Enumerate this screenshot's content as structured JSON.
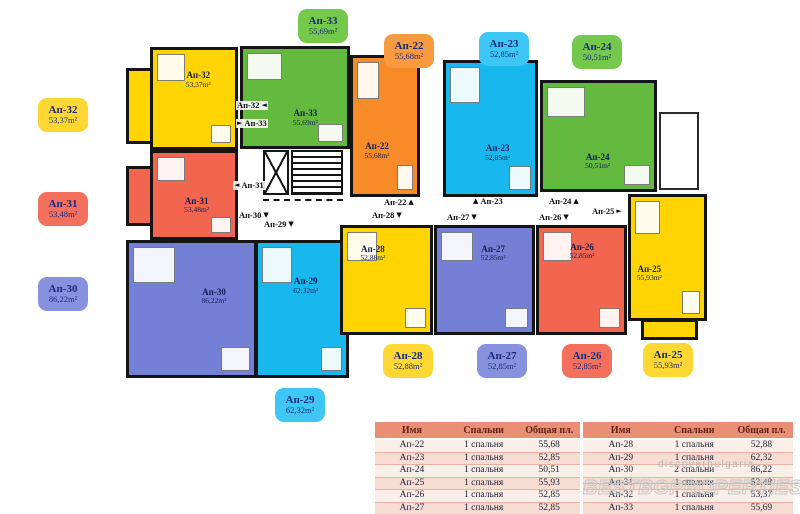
{
  "colors": {
    "yellow_unit": "#FFD400",
    "yellow_bubble": "#FFD732",
    "orange_unit": "#F68B28",
    "orange_bubble": "#F89A40",
    "red_unit": "#F26650",
    "red_bubble": "#F4705C",
    "green_unit": "#63BA3E",
    "green_bubble": "#74C94C",
    "cyan_unit": "#18B8EF",
    "cyan_bubble": "#3EC6F4",
    "blue_unit": "#7480D6",
    "blue_bubble": "#8792DF",
    "wall": "#141414",
    "table_header_bg": "#EA8F76"
  },
  "units": {
    "ap22": {
      "name": "Ап-22",
      "area": "55,68m²"
    },
    "ap23": {
      "name": "Ап-23",
      "area": "52,85m²"
    },
    "ap24": {
      "name": "Ап-24",
      "area": "50,51m²"
    },
    "ap25": {
      "name": "Ап-25",
      "area": "55,93m²"
    },
    "ap26": {
      "name": "Ап-26",
      "area": "52,85m²"
    },
    "ap27": {
      "name": "Ап-27",
      "area": "52,85m²"
    },
    "ap28": {
      "name": "Ап-28",
      "area": "52,88m²"
    },
    "ap29": {
      "name": "Ап-29",
      "area": "62,32m²"
    },
    "ap30": {
      "name": "Ап-30",
      "area": "86,22m²"
    },
    "ap31": {
      "name": "Ап-31",
      "area": "53,48m²"
    },
    "ap32": {
      "name": "Ап-32",
      "area": "53,37m²"
    },
    "ap33": {
      "name": "Ап-33",
      "area": "55,69m²"
    }
  },
  "corridor": {
    "ap32": {
      "label": "Ап-32",
      "arrow": "◄"
    },
    "ap33": {
      "label": "Ап-33",
      "arrow": "►"
    },
    "ap31": {
      "label": "Ап-31",
      "arrow": "◄"
    },
    "ap30": {
      "label": "Ап-30",
      "arrow": "▼"
    },
    "ap29": {
      "label": "Ап-29",
      "arrow": "▼"
    },
    "ap22": {
      "label": "Ап-22",
      "arrow": "▲"
    },
    "ap23": {
      "label": "Ап-23",
      "arrow": "▲"
    },
    "ap24": {
      "label": "Ап-24",
      "arrow": "▲"
    },
    "ap25": {
      "label": "Ап-25",
      "arrow": "►"
    },
    "ap26": {
      "label": "Ап-26",
      "arrow": "▼"
    },
    "ap27": {
      "label": "Ап-27",
      "arrow": "▼"
    },
    "ap28": {
      "label": "Ап-28",
      "arrow": "▼"
    }
  },
  "tables": {
    "headers": {
      "name": "Имя",
      "bedrooms": "Спальни",
      "area": "Общая пл."
    },
    "left": [
      {
        "name": "Ап-22",
        "bedrooms": "1 спальня",
        "area": "55,68"
      },
      {
        "name": "Ап-23",
        "bedrooms": "1 спальня",
        "area": "52,85"
      },
      {
        "name": "Ап-24",
        "bedrooms": "1 спальня",
        "area": "50,51"
      },
      {
        "name": "Ап-25",
        "bedrooms": "1 спальня",
        "area": "55,93"
      },
      {
        "name": "Ап-26",
        "bedrooms": "1 спальня",
        "area": "52,85"
      },
      {
        "name": "Ап-27",
        "bedrooms": "1 спальня",
        "area": "52,85"
      }
    ],
    "right": [
      {
        "name": "Ап-28",
        "bedrooms": "1 спальня",
        "area": "52,88"
      },
      {
        "name": "Ап-29",
        "bedrooms": "1 спальня",
        "area": "62,32"
      },
      {
        "name": "Ап-30",
        "bedrooms": "2 спальни",
        "area": "86,22"
      },
      {
        "name": "Ап-31",
        "bedrooms": "1 спальня",
        "area": "53,48"
      },
      {
        "name": "Ап-32",
        "bedrooms": "1 спальня",
        "area": "53,37"
      },
      {
        "name": "Ап-33",
        "bedrooms": "1 спальня",
        "area": "55,69"
      }
    ]
  },
  "watermark": {
    "small": "discoverbulgaria",
    "large": "BESTBGPROPERTIES"
  }
}
